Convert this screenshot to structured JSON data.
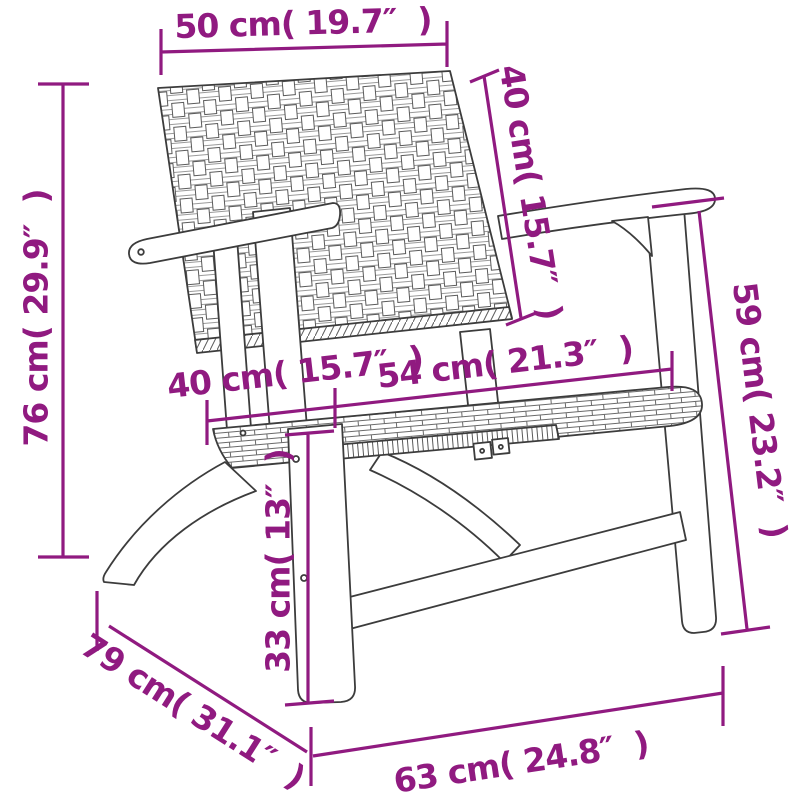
{
  "colors": {
    "dimension_accent": "#901a80",
    "line_art": "#3c3c3c",
    "background": "#ffffff"
  },
  "dimensions": {
    "top_width": {
      "label": "50 cm( 19.7″  )"
    },
    "backrest_height": {
      "label": "40 cm( 15.7″  )"
    },
    "total_height": {
      "label": "76 cm( 29.9″  )"
    },
    "side_height": {
      "label": "59 cm( 23.2″  )"
    },
    "seat_depth": {
      "label": "40 cm( 15.7″  )"
    },
    "seat_width": {
      "label": "54 cm( 21.3″  )"
    },
    "seat_height": {
      "label": "33 cm( 13″  )"
    },
    "overall_depth": {
      "label": "79 cm( 31.1″  )"
    },
    "base_width": {
      "label": "63 cm( 24.8″  )"
    }
  }
}
